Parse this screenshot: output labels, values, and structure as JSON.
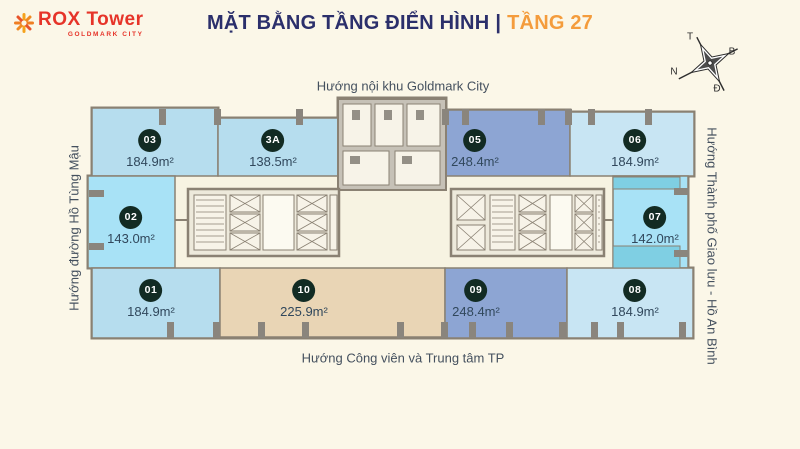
{
  "header": {
    "logo": {
      "brand": "ROX",
      "product": "Tower",
      "tagline": "GOLDMARK CITY"
    },
    "title_main": "MẶT BẰNG TẦNG ĐIỂN HÌNH",
    "title_sep": "|",
    "title_floor": "TẦNG 27"
  },
  "compass": {
    "t": "T",
    "b": "B",
    "n": "N",
    "d": "Đ"
  },
  "directions": {
    "top": "Hướng nội khu Goldmark City",
    "bottom": "Hướng Công viên và Trung tâm TP",
    "left": "Hướng đường Hồ Tùng Mậu",
    "right": "Hướng Thành phố Giao lưu - Hồ An Bình"
  },
  "colors": {
    "background": "#FBF7E8",
    "plate_fill": "#F7F3E2",
    "title_navy": "#2B2F6B",
    "accent_orange": "#F49C3C",
    "logo_red": "#E63429",
    "badge": "#122B23",
    "area_text": "#31485C",
    "direction_text": "#44505E",
    "wall": "#8A8173",
    "unit_light_blue": "#B6DDEE",
    "unit_pale_blue": "#C8E5F3",
    "unit_medium_blue": "#8DA5D3",
    "unit_cyan": "#A8E2F6",
    "unit_teal": "#7FCFE3",
    "unit_beige": "#E9D5B5",
    "core_fill": "#EDE9DB",
    "room_fill": "#F7F3E8"
  },
  "units": [
    {
      "id": "03",
      "area": "184.9m²",
      "fill": "unit_light_blue",
      "rect": [
        92,
        108,
        126,
        68
      ],
      "badge": [
        150,
        141
      ]
    },
    {
      "id": "3A",
      "area": "138.5m²",
      "fill": "unit_light_blue",
      "rect": [
        218,
        118,
        122,
        58
      ],
      "badge": [
        273,
        141
      ]
    },
    {
      "id": "05",
      "area": "248.4m²",
      "fill": "unit_medium_blue",
      "rect": [
        400,
        110,
        170,
        66
      ],
      "badge": [
        475,
        141
      ]
    },
    {
      "id": "06",
      "area": "184.9m²",
      "fill": "unit_pale_blue",
      "rect": [
        570,
        112,
        124,
        64
      ],
      "badge": [
        635,
        141
      ]
    },
    {
      "id": "02",
      "area": "143.0m²",
      "fill": "unit_cyan",
      "rect": [
        88,
        176,
        87,
        92
      ],
      "badge": [
        131,
        218
      ]
    },
    {
      "id": "07",
      "area": "142.0m²",
      "fill": "unit_cyan",
      "rect": [
        613,
        176,
        75,
        92
      ],
      "badge": [
        655,
        218
      ]
    },
    {
      "id": "01",
      "area": "184.9m²",
      "fill": "unit_light_blue",
      "rect": [
        92,
        268,
        128,
        70
      ],
      "badge": [
        151,
        291
      ]
    },
    {
      "id": "10",
      "area": "225.9m²",
      "fill": "unit_beige",
      "rect": [
        220,
        268,
        225,
        69
      ],
      "badge": [
        304,
        291
      ]
    },
    {
      "id": "09",
      "area": "248.4m²",
      "fill": "unit_medium_blue",
      "rect": [
        445,
        268,
        122,
        70
      ],
      "badge": [
        476,
        291
      ]
    },
    {
      "id": "08",
      "area": "184.9m²",
      "fill": "unit_pale_blue",
      "rect": [
        567,
        268,
        126,
        70
      ],
      "badge": [
        635,
        291
      ]
    }
  ]
}
